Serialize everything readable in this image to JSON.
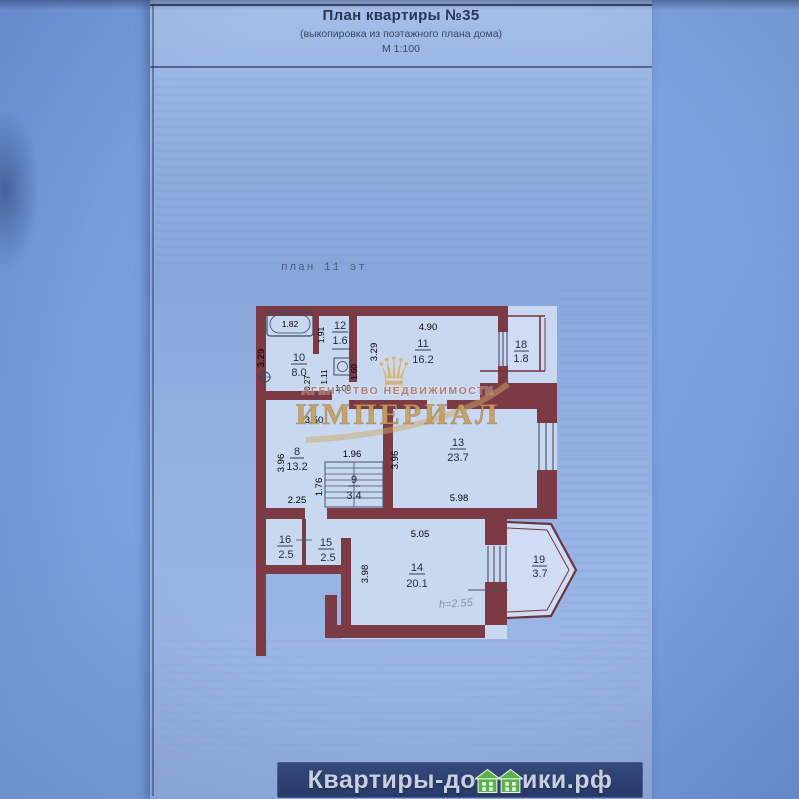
{
  "header": {
    "title": "План квартиры №35",
    "subtitle": "(выкопировка из поэтажного плана дома)",
    "scale": "М 1:100"
  },
  "plan": {
    "floor_label": "план 11 эт",
    "rooms": [
      {
        "num": "10",
        "area": "8.0"
      },
      {
        "num": "12",
        "area": "1.6"
      },
      {
        "num": "11",
        "area": "16.2"
      },
      {
        "num": "18",
        "area": "1.8"
      },
      {
        "num": "8",
        "area": "13.2"
      },
      {
        "num": "9",
        "area": "3.4"
      },
      {
        "num": "13",
        "area": "23.7"
      },
      {
        "num": "16",
        "area": "2.5"
      },
      {
        "num": "15",
        "area": "2.5"
      },
      {
        "num": "14",
        "area": "20.1"
      },
      {
        "num": "19",
        "area": "3.7"
      }
    ],
    "dims": {
      "bath": "1.82",
      "v329_left": "3.29",
      "v191": "1.91",
      "v027": "0.27",
      "v111": "1.11",
      "v160": "1.60",
      "h100": "1.00",
      "h490": "4.90",
      "v329_room11": "3.29",
      "h350": "3.50",
      "v396_room8": "3.96",
      "h196": "1.96",
      "v176": "1.76",
      "h225": "2.25",
      "v396_room13": "3.96",
      "h598": "5.98",
      "h505": "5.05",
      "v398_room14": "3.98",
      "note": "h=2.55"
    },
    "colors": {
      "wall": "#7b3a44",
      "room_fill": "#c9d8f1",
      "paper_blue": "#8fadde"
    }
  },
  "watermark": {
    "crown": "♛",
    "agency_small": "АГЕНТСТВО  НЕДВИЖИМОСТИ",
    "agency_big": "ИМПЕРИАЛ",
    "gold": "#c8a express06a"
  },
  "footer": {
    "site_prefix": "Квартиры-до",
    "site_suffix": "ики.рф",
    "site_full": "Квартиры-домики.рф",
    "house_green": "#58b14a"
  }
}
